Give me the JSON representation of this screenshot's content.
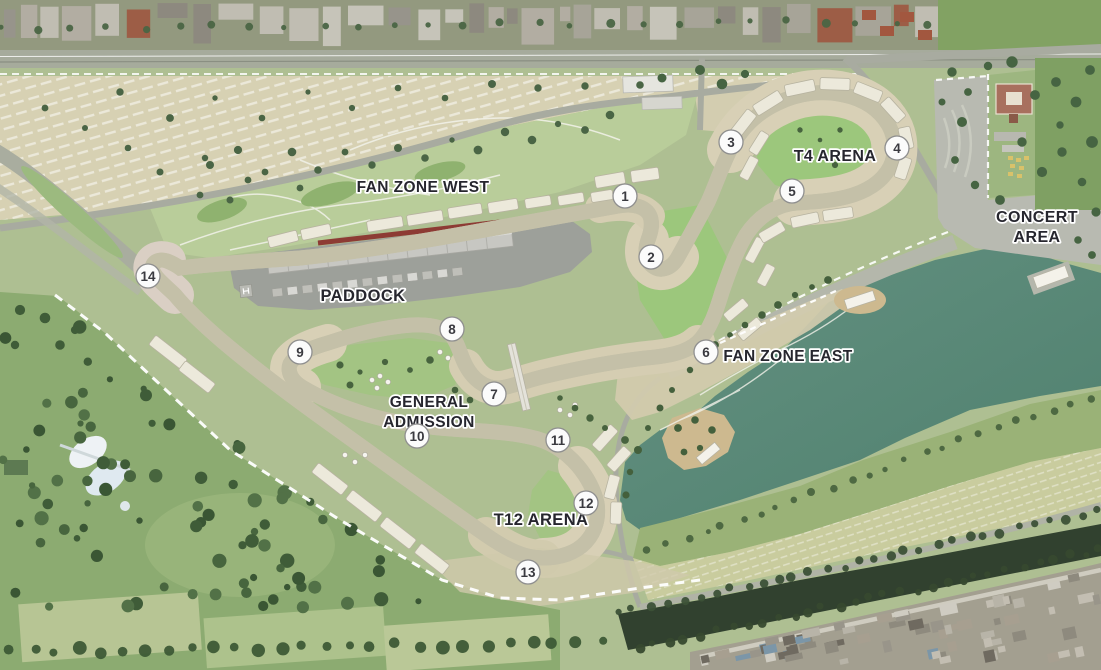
{
  "map": {
    "type": "circuit-venue-aerial-masterplan",
    "zones": [
      {
        "id": "fan-zone-west",
        "lines": [
          "FAN ZONE WEST"
        ],
        "x": 423,
        "y": 192,
        "size": 15.5
      },
      {
        "id": "t4-arena",
        "lines": [
          "T4 ARENA"
        ],
        "x": 835,
        "y": 161,
        "size": 16
      },
      {
        "id": "concert-area",
        "lines": [
          "CONCERT",
          "AREA"
        ],
        "x": 1037,
        "y": 222,
        "size": 16
      },
      {
        "id": "paddock",
        "lines": [
          "PADDOCK"
        ],
        "x": 363,
        "y": 301,
        "size": 16.5
      },
      {
        "id": "fan-zone-east",
        "lines": [
          "FAN ZONE EAST"
        ],
        "x": 788,
        "y": 361,
        "size": 15.5
      },
      {
        "id": "general-admission",
        "lines": [
          "GENERAL",
          "ADMISSION"
        ],
        "x": 429,
        "y": 407,
        "size": 15.5
      },
      {
        "id": "t12-arena",
        "lines": [
          "T12 ARENA"
        ],
        "x": 541,
        "y": 525,
        "size": 16.5
      }
    ],
    "line_height": 20,
    "turn_markers": [
      {
        "n": "1",
        "x": 625,
        "y": 196
      },
      {
        "n": "2",
        "x": 651,
        "y": 257
      },
      {
        "n": "3",
        "x": 731,
        "y": 142
      },
      {
        "n": "4",
        "x": 897,
        "y": 148
      },
      {
        "n": "5",
        "x": 792,
        "y": 191
      },
      {
        "n": "6",
        "x": 706,
        "y": 352
      },
      {
        "n": "7",
        "x": 494,
        "y": 394
      },
      {
        "n": "8",
        "x": 452,
        "y": 329
      },
      {
        "n": "9",
        "x": 300,
        "y": 352
      },
      {
        "n": "10",
        "x": 417,
        "y": 436
      },
      {
        "n": "11",
        "x": 558,
        "y": 440
      },
      {
        "n": "12",
        "x": 586,
        "y": 503
      },
      {
        "n": "13",
        "x": 528,
        "y": 572
      },
      {
        "n": "14",
        "x": 148,
        "y": 276
      }
    ],
    "marker_style": {
      "radius": 12,
      "fill": "#fbfbfb",
      "stroke": "#8f8f8f",
      "text_color": "#3a3a40"
    },
    "label_style": {
      "color": "#26262e",
      "halo": "#ffffff"
    },
    "palette": {
      "grass_base": "#aebf92",
      "grass_bright": "#9cc77c",
      "grass_light": "#b9cd9a",
      "park_green": "#8cab71",
      "tree_dark": "#47633e",
      "parking_tan": "#d7d1b3",
      "runoff_tan": "#d8d0b6",
      "road_gray": "#a8aba0",
      "paved_gray": "#b8bab1",
      "paddock_gray": "#9da09a",
      "track_asphalt": "#3e4145",
      "track_casing": "#c4c0a8",
      "water_teal": "#5c8f7c",
      "river_dark": "#31412f",
      "urban_gray": "#a39f90",
      "grandstand": "#ece9db"
    }
  }
}
